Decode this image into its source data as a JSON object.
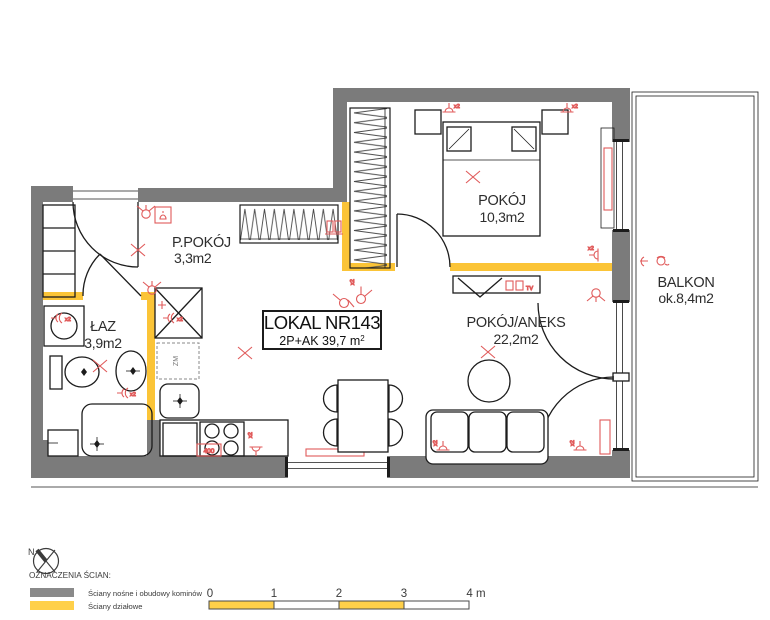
{
  "title_box": {
    "line1": "LOKAL NR143",
    "line2_prefix": "2P+AK  39,7 m",
    "line2_sup": "2"
  },
  "rooms": [
    {
      "name": "P.POKÓJ",
      "area": "3,3m2"
    },
    {
      "name": "ŁAZ",
      "area": "3,9m2"
    },
    {
      "name": "POKÓJ",
      "area": "10,3m2"
    },
    {
      "name": "POKÓJ/ANEKS",
      "area": "22,2m2"
    },
    {
      "name": "BALKON",
      "area": "ok.8,4m2"
    }
  ],
  "annotations": {
    "x2": "x2",
    "socket_400": "400",
    "dishwasher": "ZM",
    "tv": "TV"
  },
  "compass": {
    "north": "N"
  },
  "legend": {
    "heading": "OZNACZENIA ŚCIAN:",
    "items": [
      {
        "label": "Ściany nośne i obudowy kominów",
        "color": "#8a8a8a"
      },
      {
        "label": "Ściany działowe",
        "color": "#FFD04A"
      }
    ]
  },
  "scale_bar": {
    "ticks": [
      "0",
      "1",
      "2",
      "3",
      "4 m"
    ]
  },
  "colors": {
    "load_bearing_wall": "#7b7b7b",
    "partition_wall": "#FBC437",
    "electrical": "#E05A5A"
  }
}
